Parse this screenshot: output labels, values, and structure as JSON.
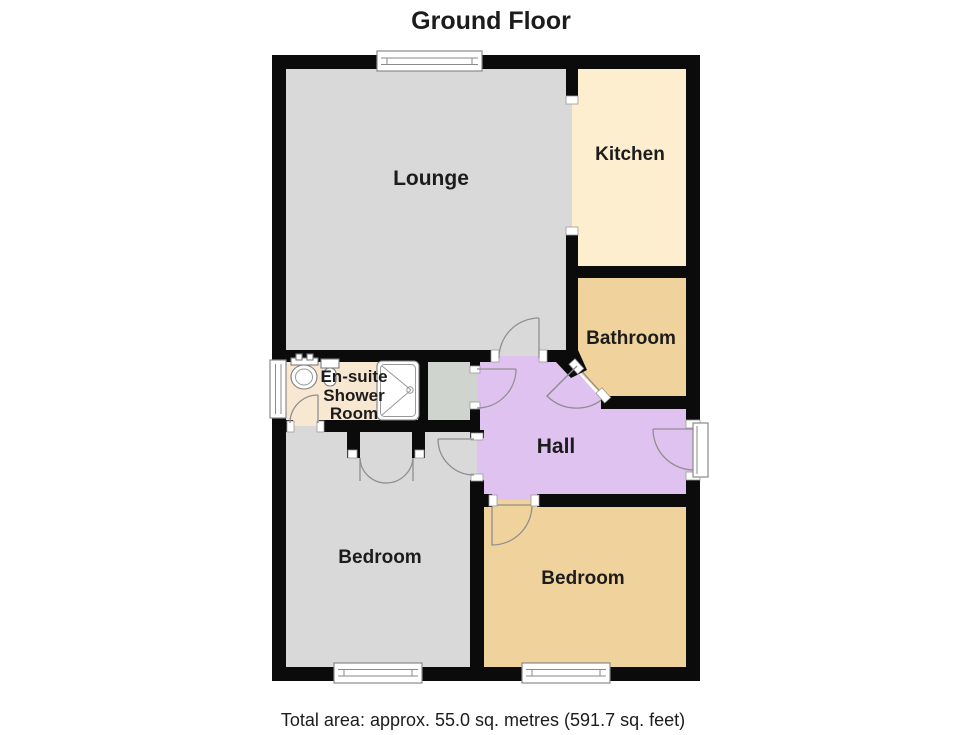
{
  "title": "Ground Floor",
  "footer": "Total area: approx. 55.0 sq. metres (591.7 sq. feet)",
  "wall_color": "#0b0b0b",
  "rooms": {
    "lounge": {
      "label": "Lounge",
      "color": "#d9d9d9"
    },
    "kitchen": {
      "label": "Kitchen",
      "color": "#fdeecf"
    },
    "bathroom": {
      "label": "Bathroom",
      "color": "#f0d29c"
    },
    "hall": {
      "label": "Hall",
      "color": "#e0c2f1"
    },
    "ensuite": {
      "lines": [
        "En-suite",
        "Shower",
        "Room"
      ],
      "color": "#f8e8d2"
    },
    "cupboard": {
      "color": "#cfd4cf"
    },
    "bedroom_left": {
      "label": "Bedroom",
      "color": "#d9d9d9"
    },
    "bedroom_right": {
      "label": "Bedroom",
      "color": "#f0d29c"
    }
  }
}
